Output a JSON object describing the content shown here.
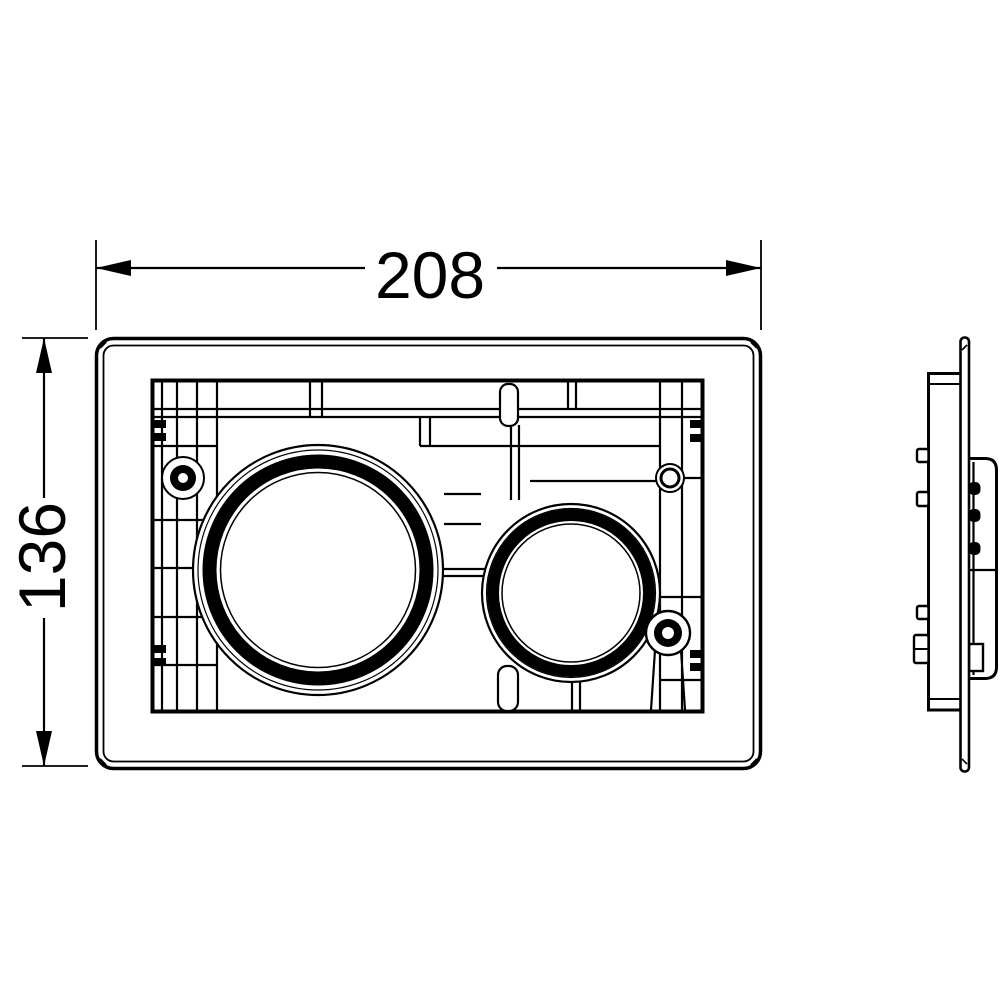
{
  "drawing": {
    "ink_color": "#000000",
    "background_color": "#ffffff",
    "dimensions": {
      "width_label": "208",
      "height_label": "136"
    }
  }
}
